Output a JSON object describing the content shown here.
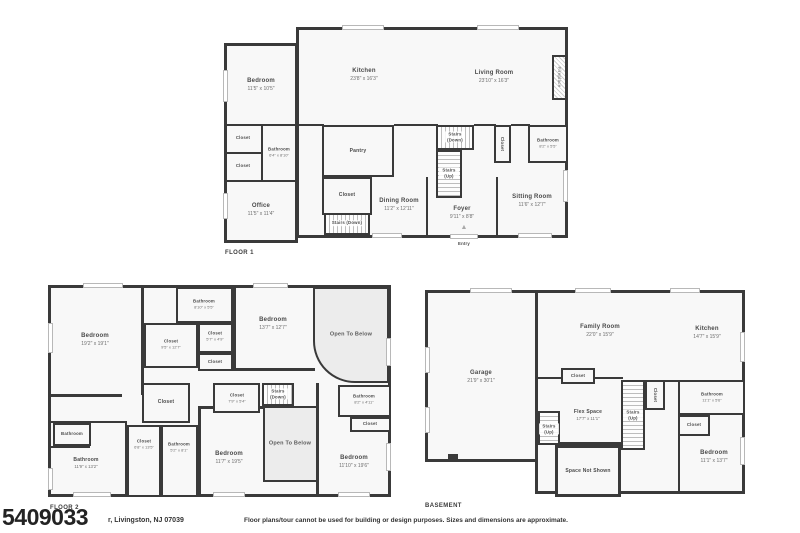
{
  "page": {
    "colors": {
      "wall": "#3a3a3a",
      "room_fill": "#f8f8f8",
      "open_fill": "#ececec"
    },
    "footer": {
      "mls_number": "5409033",
      "address_visible": "r, Livingston, NJ 07039",
      "disclaimer": "Floor plans/tour cannot be used for building or design purposes. Sizes and dimensions are approximate."
    }
  },
  "floor1": {
    "label": "FLOOR 1",
    "entry_arrow_icon": "▲",
    "rooms": {
      "bedroom": {
        "name": "Bedroom",
        "dims": "11'5\" x 10'5\""
      },
      "kitchen": {
        "name": "Kitchen",
        "dims": "23'8\" x 16'3\""
      },
      "living": {
        "name": "Living Room",
        "dims": "23'10\" x 16'3\""
      },
      "closet_a": {
        "name": "Closet"
      },
      "closet_b": {
        "name": "Closet"
      },
      "bathroom_left": {
        "name": "Bathroom",
        "dims": "6'4\" x 8'10\""
      },
      "office": {
        "name": "Office",
        "dims": "11'5\" x 11'4\""
      },
      "pantry": {
        "name": "Pantry"
      },
      "closet_c": {
        "name": "Closet"
      },
      "stairs_down_a": {
        "name": "Stairs (Down)"
      },
      "dining": {
        "name": "Dining Room",
        "dims": "11'2\" x 12'11\""
      },
      "stairs_down_b": {
        "name": "Stairs (Down)"
      },
      "stairs_up": {
        "name": "Stairs (Up)"
      },
      "foyer": {
        "name": "Foyer",
        "dims": "9'11\" x 8'8\""
      },
      "closet_d": {
        "name": "Closet"
      },
      "bathroom_right": {
        "name": "Bathroom",
        "dims": "8'2\" x 5'5\""
      },
      "sitting": {
        "name": "Sitting Room",
        "dims": "11'6\" x 12'7\""
      },
      "fireplace": {
        "name": "Fireplace"
      },
      "entry": {
        "name": "Entry"
      }
    }
  },
  "floor2": {
    "label": "FLOOR 2",
    "rooms": {
      "bedroom_tl": {
        "name": "Bedroom",
        "dims": "19'2\" x 19'1\""
      },
      "bathroom_top": {
        "name": "Bathroom",
        "dims": "8'10\" x 5'5\""
      },
      "closet_a": {
        "name": "Closet",
        "dims": "9'5\" x 12'7\""
      },
      "closet_b": {
        "name": "Closet",
        "dims": "5'7\" x 4'9\""
      },
      "closet_c": {
        "name": "Closet"
      },
      "bedroom_top": {
        "name": "Bedroom",
        "dims": "13'7\" x 12'7\""
      },
      "open_top": {
        "name": "Open To Below"
      },
      "closet_mid": {
        "name": "Closet"
      },
      "closet_d": {
        "name": "Closet",
        "dims": "7'9\" x 5'4\""
      },
      "stairs_down": {
        "name": "Stairs (Down)"
      },
      "bathroom_right": {
        "name": "Bathroom",
        "dims": "8'2\" x 4'11\""
      },
      "closet_right": {
        "name": "Closet"
      },
      "bathroom_small": {
        "name": "Bathroom"
      },
      "bathroom_bl": {
        "name": "Bathroom",
        "dims": "11'9\" x 13'2\""
      },
      "closet_e": {
        "name": "Closet",
        "dims": "6'8\" x 13'5\""
      },
      "bathroom_mid": {
        "name": "Bathroom",
        "dims": "5'2\" x 8'1\""
      },
      "bedroom_bottom": {
        "name": "Bedroom",
        "dims": "11'7\" x 19'5\""
      },
      "open_bottom": {
        "name": "Open To Below"
      },
      "bedroom_br": {
        "name": "Bedroom",
        "dims": "11'10\" x 19'6\""
      }
    }
  },
  "basement": {
    "label": "BASEMENT",
    "rooms": {
      "garage": {
        "name": "Garage",
        "dims": "21'9\" x 30'1\""
      },
      "family": {
        "name": "Family Room",
        "dims": "22'0\" x 15'9\""
      },
      "kitchen": {
        "name": "Kitchen",
        "dims": "14'7\" x 15'9\""
      },
      "closet_top": {
        "name": "Closet"
      },
      "flex": {
        "name": "Flex Space",
        "dims": "17'7\" x 11'1\""
      },
      "stairs_a": {
        "name": "Stairs (Up)"
      },
      "stairs_b": {
        "name": "Stairs (Up)"
      },
      "closet_vert": {
        "name": "Closet"
      },
      "bathroom": {
        "name": "Bathroom",
        "dims": "11'1\" x 5'6\""
      },
      "closet_b": {
        "name": "Closet"
      },
      "bedroom": {
        "name": "Bedroom",
        "dims": "11'1\" x 13'7\""
      },
      "space_not_shown": {
        "name": "Space Not Shown"
      }
    }
  }
}
